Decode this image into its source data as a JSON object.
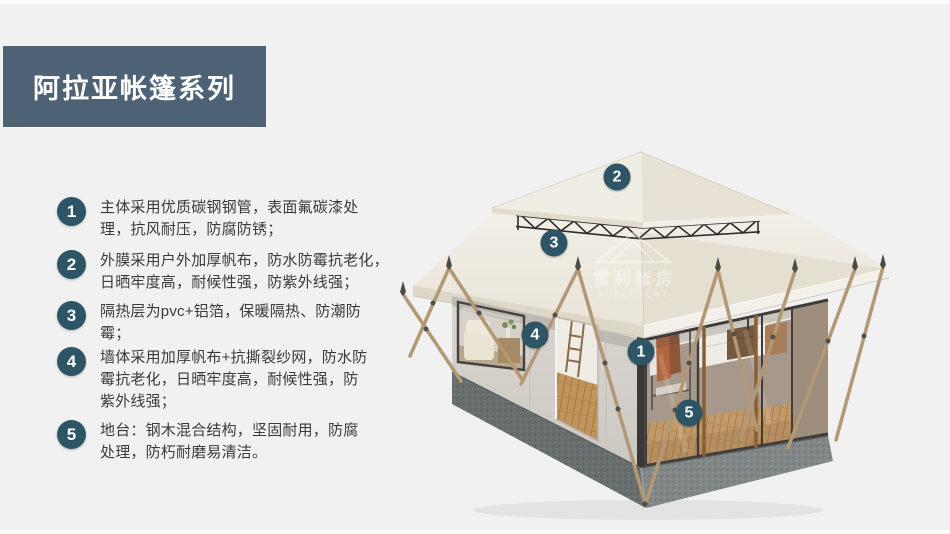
{
  "colors": {
    "page_bg": "#f1f1f2",
    "banner_bg": "#4d6375",
    "badge_bg": "#2e5566",
    "body_text": "#3a3a3a"
  },
  "header": {
    "title": "阿拉亚帐篷系列"
  },
  "features": {
    "items": [
      {
        "number": "1",
        "lines": [
          "主体采用优质碳钢钢管，表面氟碳漆处",
          "理，抗风耐压，防腐防锈；"
        ]
      },
      {
        "number": "2",
        "lines": [
          "外膜采用户外加厚帆布，防水防霉抗老化，",
          "日晒牢度高，耐候性强，防紫外线强；"
        ]
      },
      {
        "number": "3",
        "lines": [
          "隔热层为pvc+铝箔，保暖隔热、防潮防",
          "霉；"
        ]
      },
      {
        "number": "4",
        "lines": [
          "墙体采用加厚帆布+抗撕裂纱网，防水防",
          "霉抗老化，日晒牢度高，耐候性强，防",
          "紫外线强；"
        ]
      },
      {
        "number": "5",
        "lines": [
          "地台：钢木混合结构，坚固耐用，防腐",
          "处理，防朽耐磨易清洁。"
        ]
      }
    ]
  },
  "diagram": {
    "watermark": {
      "cn": "雪利帐房",
      "en": "XUELI TENT"
    },
    "callouts": [
      {
        "number": "2",
        "x": 617,
        "y": 177
      },
      {
        "number": "3",
        "x": 554,
        "y": 243
      },
      {
        "number": "4",
        "x": 535,
        "y": 335
      },
      {
        "number": "1",
        "x": 641,
        "y": 352
      },
      {
        "number": "5",
        "x": 689,
        "y": 413
      }
    ]
  }
}
